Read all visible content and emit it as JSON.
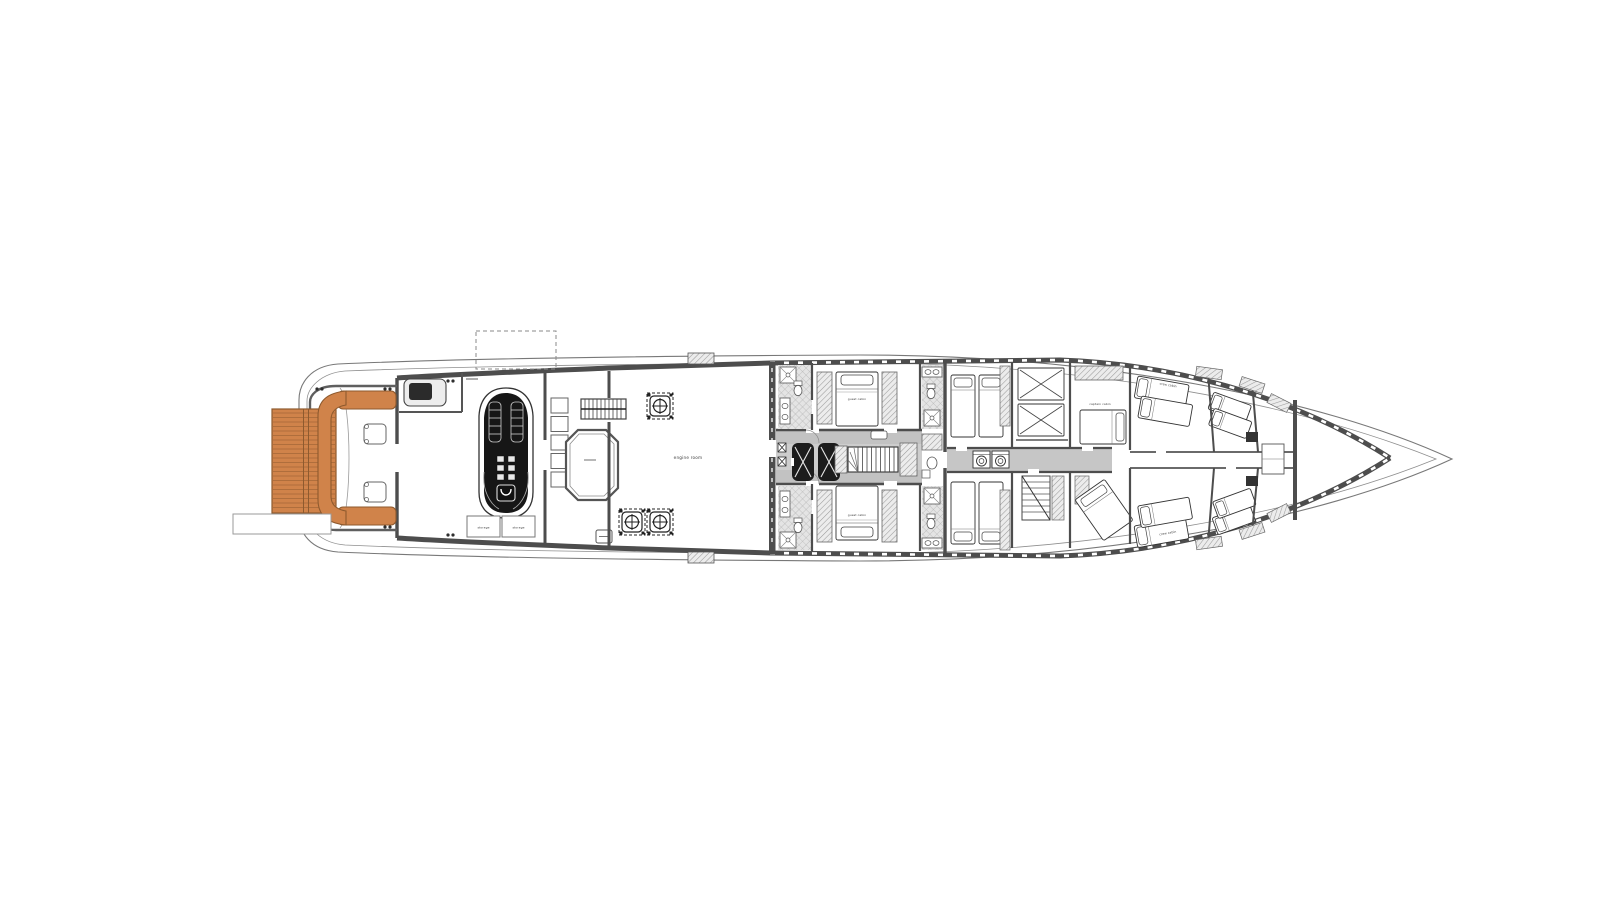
{
  "diagram": {
    "type": "yacht-lower-deck-floor-plan",
    "labels": {
      "engine_room": "engine room",
      "storage_a": "storage",
      "storage_b": "storage",
      "guest_cabin_aft_top": "guest cabin",
      "guest_cabin_aft_bottom": "guest cabin",
      "captain_cabin": "captain cabin",
      "crew_cabin_top": "crew cabin",
      "crew_cabin_bottom": "crew cabin"
    },
    "colors": {
      "wood": "#d0834a",
      "wood_dark": "#8e5a2e",
      "wall": "#4d4d4d",
      "wall_light": "#8c8c8c",
      "floor": "#c2c2c2",
      "floor_light": "#cdcdcd",
      "black_fill": "#161616",
      "line": "#5a5a5a"
    }
  }
}
